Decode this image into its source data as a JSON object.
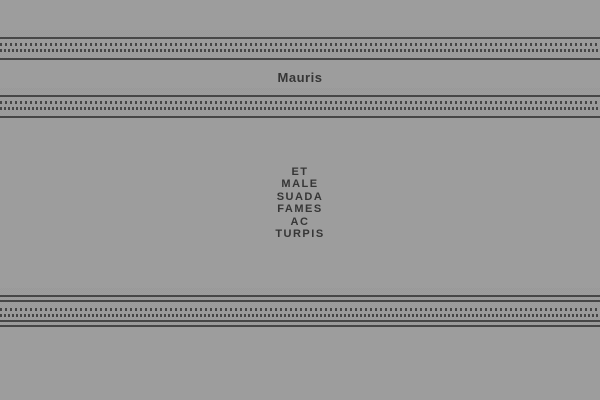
{
  "colors": {
    "background": "#9d9d9d",
    "rule": "#464646",
    "text": "#363636"
  },
  "header": {
    "title": "Mauris"
  },
  "content": {
    "lines": [
      "ET",
      "MALE",
      "SUADA",
      "FAMES",
      "AC",
      "TURPIS"
    ]
  }
}
